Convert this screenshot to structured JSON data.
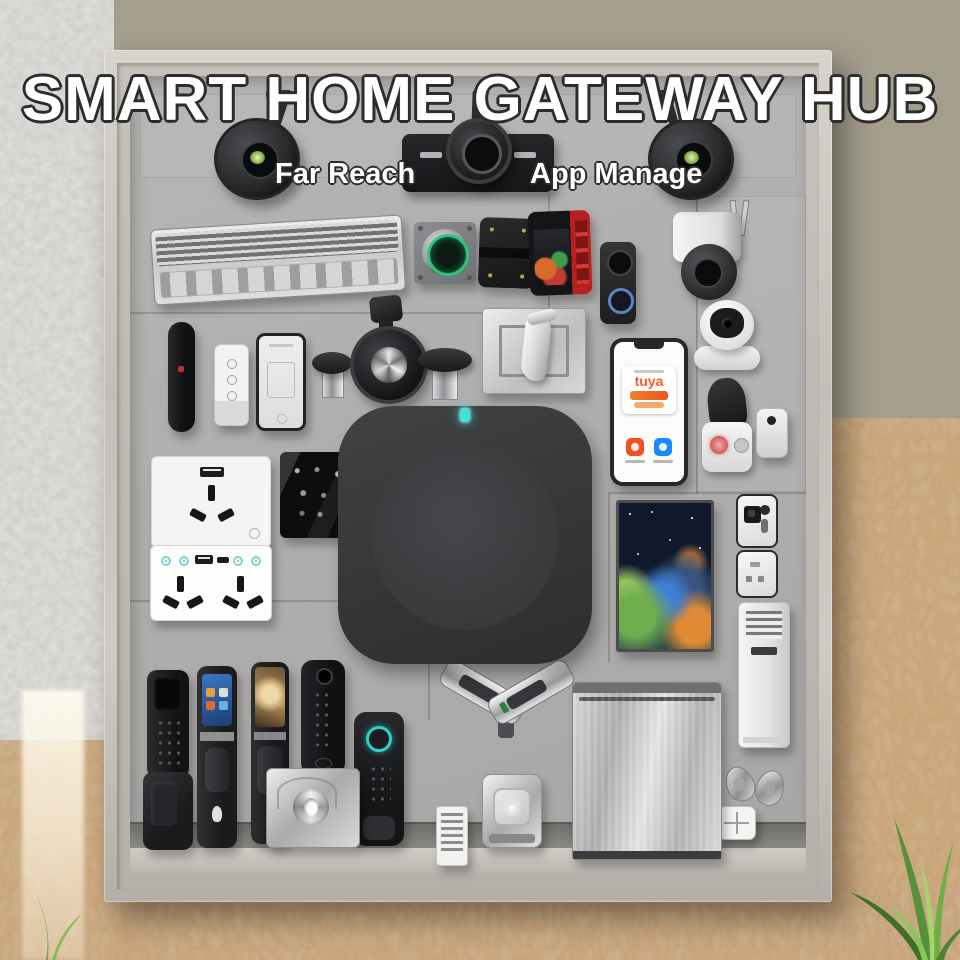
{
  "header": {
    "title": "SMART HOME GATEWAY HUB",
    "features": [
      {
        "label": "Far Reach"
      },
      {
        "label": "App Manage"
      }
    ]
  },
  "phone": {
    "brand": "tuya",
    "brand_color": "#ff5a21",
    "app_icons": [
      {
        "name": "tuya-smart-app-icon",
        "color": "#f25024"
      },
      {
        "name": "smart-life-app-icon",
        "color": "#1989fa"
      }
    ]
  },
  "hub": {
    "status_led_color": "#45e0da"
  },
  "palette": {
    "wall_olive": "#a49e8d",
    "wall_gray_texture": "#cfcecb",
    "board_gray": "#b1b0ae",
    "frame_wood": "#cfcbc4",
    "osb_wood": "#c49a6a",
    "hub_black": "#3a3b3d",
    "accent_teal": "#45e0da",
    "thermostat_green": "#27c87a"
  },
  "board": {
    "devices": [
      "floodlight-camera-left",
      "bullet-camera-center",
      "floodlight-camera-right",
      "led-light-bar",
      "smart-thermostat",
      "relay-module",
      "energy-control-panel",
      "video-doorbell",
      "outdoor-ptz-camera",
      "remote-control-black",
      "smart-remote-white",
      "smartphone-small",
      "smart-knob-left",
      "camera-gimbal",
      "smart-knob-right",
      "door-lever-plate",
      "smartphone-tuya-app",
      "indoor-camera",
      "smart-siren",
      "mini-sensor",
      "gateway-hub",
      "usb-wall-socket",
      "touch-glass-socket",
      "double-usb-socket",
      "smart-display",
      "video-intercom",
      "tower-air-conditioner",
      "earbuds",
      "scene-switch",
      "smart-lock-keypad",
      "smart-lock-screen",
      "smart-lock-peephole",
      "smart-lock-slim",
      "rim-lock",
      "fingerprint-lock",
      "door-closer-pair",
      "mini-vent",
      "cube-camera",
      "steel-panel"
    ]
  }
}
